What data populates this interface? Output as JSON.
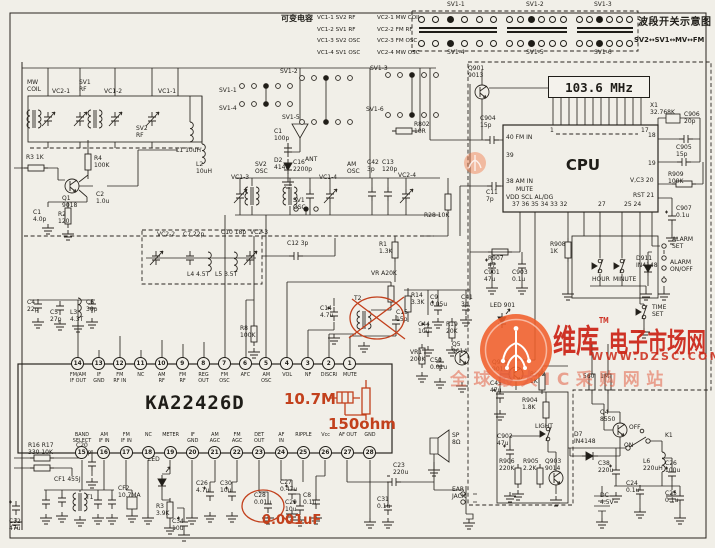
{
  "page": {
    "bg": "#f1efe8",
    "ink": "#1f1d18",
    "red": "#c2401c"
  },
  "legend": {
    "title": "可变电容",
    "rows": [
      [
        "VC1-1 SV2 RF",
        "VC2-1 MW COIL"
      ],
      [
        "VC1-2 SV1 RF",
        "VC2-2 FM RF"
      ],
      [
        "VC1-3 SV2 OSC",
        "VC2-3 FM OSC"
      ],
      [
        "VC1-4 SV1 OSC",
        "VC2-4 MW OSC"
      ]
    ]
  },
  "band_switch": {
    "title": "波段开关示意图",
    "formula": "SV2↔SV1↔MV↔FM",
    "blocks": [
      {
        "top": "SV1-1",
        "bottom": "SV1-4"
      },
      {
        "top": "SV1-2",
        "bottom": "SV1-5"
      },
      {
        "top": "SV1-3",
        "bottom": "SV1-6"
      }
    ]
  },
  "main_ic": {
    "part": "KA22426D",
    "top_pins": [
      {
        "n": "14",
        "label": "FM/AM\nIF OUT"
      },
      {
        "n": "13",
        "label": "IF\nGND"
      },
      {
        "n": "12",
        "label": "FM\nRF IN"
      },
      {
        "n": "11",
        "label": "NC"
      },
      {
        "n": "10",
        "label": "AM\nRF"
      },
      {
        "n": "9",
        "label": "FM\nRF"
      },
      {
        "n": "8",
        "label": "REG\nOUT"
      },
      {
        "n": "7",
        "label": "FM\nOSC"
      },
      {
        "n": "6",
        "label": "AFC"
      },
      {
        "n": "5",
        "label": "AM\nOSC"
      },
      {
        "n": "4",
        "label": "VOL"
      },
      {
        "n": "3",
        "label": "NF"
      },
      {
        "n": "2",
        "label": "DISCRI"
      },
      {
        "n": "1",
        "label": "MUTE"
      }
    ],
    "bottom_pins": [
      {
        "n": "15",
        "label": "BAND\nSELECT"
      },
      {
        "n": "16",
        "label": "AM\nIF IN"
      },
      {
        "n": "17",
        "label": "FM\nIF IN"
      },
      {
        "n": "18",
        "label": "NC"
      },
      {
        "n": "19",
        "label": "METER"
      },
      {
        "n": "20",
        "label": "IF\nGND"
      },
      {
        "n": "21",
        "label": "AM\nAGC"
      },
      {
        "n": "22",
        "label": "FM\nAGC"
      },
      {
        "n": "23",
        "label": "DET\nOUT"
      },
      {
        "n": "24",
        "label": "AF\nIN"
      },
      {
        "n": "25",
        "label": "RIPPLE"
      },
      {
        "n": "26",
        "label": "Vcc"
      },
      {
        "n": "27",
        "label": "AF OUT"
      },
      {
        "n": "28",
        "label": "GND"
      }
    ]
  },
  "cpu": {
    "label": "CPU",
    "display": "103.6 MHz"
  },
  "red_notes": {
    "filter": "10.7M",
    "resistor": "150ohm",
    "capacitor": "0.001uF"
  },
  "watermark": {
    "brand_big": "维库",
    "brand_rest": "电子市场网",
    "tm": "TM",
    "url": "WWW.DZSC.COM",
    "slogan": "全球最大IC采购网站"
  },
  "labels": [
    {
      "t": "MW\nCOIL",
      "x": 27,
      "y": 80
    },
    {
      "t": "VC2-1",
      "x": 52,
      "y": 89
    },
    {
      "t": "SV1\nRF",
      "x": 79,
      "y": 80
    },
    {
      "t": "VC1-2",
      "x": 104,
      "y": 89
    },
    {
      "t": "VC1-1",
      "x": 158,
      "y": 89
    },
    {
      "t": "SV2\nRF",
      "x": 136,
      "y": 126
    },
    {
      "t": "L1 10uH",
      "x": 176,
      "y": 148
    },
    {
      "t": "L2\n10uH",
      "x": 196,
      "y": 162
    },
    {
      "t": "R3 1K",
      "x": 26,
      "y": 155
    },
    {
      "t": "R4\n100K",
      "x": 94,
      "y": 156
    },
    {
      "t": "Q1\n9018",
      "x": 62,
      "y": 196
    },
    {
      "t": "C2\n1.0u",
      "x": 96,
      "y": 192
    },
    {
      "t": "C1\n4.0p",
      "x": 33,
      "y": 210
    },
    {
      "t": "R2\n120",
      "x": 58,
      "y": 212
    },
    {
      "t": "C4\n22p",
      "x": 27,
      "y": 300
    },
    {
      "t": "C5\n27p",
      "x": 50,
      "y": 310
    },
    {
      "t": "L3\n4.3T",
      "x": 70,
      "y": 310
    },
    {
      "t": "C6\n30p",
      "x": 86,
      "y": 300
    },
    {
      "t": "SV1-1",
      "x": 219,
      "y": 88
    },
    {
      "t": "SV1-4",
      "x": 219,
      "y": 106
    },
    {
      "t": "SV1-2",
      "x": 280,
      "y": 69
    },
    {
      "t": "SV1-5",
      "x": 282,
      "y": 115
    },
    {
      "t": "SV1-3",
      "x": 370,
      "y": 66
    },
    {
      "t": "SV1-6",
      "x": 366,
      "y": 107
    },
    {
      "t": "C1\n100p",
      "x": 274,
      "y": 129
    },
    {
      "t": "D2\n4148",
      "x": 274,
      "y": 158
    },
    {
      "t": "ANT",
      "x": 305,
      "y": 157,
      "n": "antenna-label"
    },
    {
      "t": "R802\n10R",
      "x": 414,
      "y": 122
    },
    {
      "t": "VC1-3",
      "x": 231,
      "y": 175
    },
    {
      "t": "SV2\nOSC",
      "x": 255,
      "y": 162
    },
    {
      "t": "C16\n2200p",
      "x": 293,
      "y": 160
    },
    {
      "t": "SV1\nOSC",
      "x": 293,
      "y": 198
    },
    {
      "t": "VC1-4",
      "x": 319,
      "y": 175
    },
    {
      "t": "AM\nOSC",
      "x": 347,
      "y": 162
    },
    {
      "t": "C42\n3p",
      "x": 367,
      "y": 160
    },
    {
      "t": "C13\n120p",
      "x": 382,
      "y": 160
    },
    {
      "t": "VC2-4",
      "x": 398,
      "y": 173
    },
    {
      "t": "C10 18p",
      "x": 221,
      "y": 230
    },
    {
      "t": "VC2-3",
      "x": 250,
      "y": 230
    },
    {
      "t": "C12 3p",
      "x": 287,
      "y": 241
    },
    {
      "t": "VC2-2",
      "x": 157,
      "y": 232
    },
    {
      "t": "C7 22p",
      "x": 183,
      "y": 232
    },
    {
      "t": "L4 4.5T",
      "x": 187,
      "y": 272
    },
    {
      "t": "L5 3.5T",
      "x": 215,
      "y": 272
    },
    {
      "t": "R1\n1.3K",
      "x": 379,
      "y": 242
    },
    {
      "t": "R28 10K",
      "x": 424,
      "y": 213
    },
    {
      "t": "R8\n100K",
      "x": 240,
      "y": 326
    },
    {
      "t": "VR A20K",
      "x": 371,
      "y": 271
    },
    {
      "t": "T2",
      "x": 354,
      "y": 296
    },
    {
      "t": "R14\n3.3K",
      "x": 411,
      "y": 293
    },
    {
      "t": "C15\n15p",
      "x": 396,
      "y": 310
    },
    {
      "t": "C14\n4.7u",
      "x": 320,
      "y": 306
    },
    {
      "t": "C9\n0.05u",
      "x": 430,
      "y": 295
    },
    {
      "t": "C41\n3p",
      "x": 461,
      "y": 295
    },
    {
      "t": "C44\n10u",
      "x": 418,
      "y": 322
    },
    {
      "t": "R19\n20K",
      "x": 446,
      "y": 322
    },
    {
      "t": "VR1\n200K",
      "x": 410,
      "y": 350
    },
    {
      "t": "C50\n0.01u",
      "x": 430,
      "y": 358
    },
    {
      "t": "Q5\n9014",
      "x": 452,
      "y": 342
    },
    {
      "t": "R16 R17\n330 10K",
      "x": 28,
      "y": 443
    },
    {
      "t": "C20\n100p",
      "x": 76,
      "y": 443
    },
    {
      "t": "CF1 455J",
      "x": 54,
      "y": 477
    },
    {
      "t": "T1",
      "x": 86,
      "y": 495
    },
    {
      "t": "C32\n47u",
      "x": 9,
      "y": 519
    },
    {
      "t": "CF2\n10.7MA",
      "x": 118,
      "y": 486
    },
    {
      "t": "LED",
      "x": 148,
      "y": 457
    },
    {
      "t": "R3\n3.9K",
      "x": 156,
      "y": 504
    },
    {
      "t": "C34\n10u",
      "x": 172,
      "y": 519
    },
    {
      "t": "C26\n4.7u",
      "x": 196,
      "y": 481
    },
    {
      "t": "C30\n10u",
      "x": 220,
      "y": 481
    },
    {
      "t": "C28\n0.01u",
      "x": 254,
      "y": 493
    },
    {
      "t": "C27\n0.47u",
      "x": 280,
      "y": 480
    },
    {
      "t": "C29\n10u",
      "x": 285,
      "y": 500
    },
    {
      "t": "C8\n0.1u",
      "x": 303,
      "y": 493
    },
    {
      "t": "C31\n0.1u",
      "x": 377,
      "y": 497
    },
    {
      "t": "C23\n220u",
      "x": 393,
      "y": 463
    },
    {
      "t": "SP\n8Ω",
      "x": 452,
      "y": 433,
      "n": "speaker-label"
    },
    {
      "t": "EAR\nJACK",
      "x": 452,
      "y": 487,
      "n": "ear-jack-label"
    },
    {
      "t": "Q901\n9013",
      "x": 468,
      "y": 66
    },
    {
      "t": "C904\n15p",
      "x": 480,
      "y": 116
    },
    {
      "t": "C11\n7p",
      "x": 486,
      "y": 190
    },
    {
      "t": "X1\n32.768K",
      "x": 650,
      "y": 103
    },
    {
      "t": "C906\n20p",
      "x": 684,
      "y": 112
    },
    {
      "t": "C905\n15p",
      "x": 676,
      "y": 145
    },
    {
      "t": "R909\n100K",
      "x": 668,
      "y": 172
    },
    {
      "t": "C907\n0.1u",
      "x": 676,
      "y": 206
    },
    {
      "t": "R908\n1K",
      "x": 550,
      "y": 242
    },
    {
      "t": "R907\n47",
      "x": 488,
      "y": 256
    },
    {
      "t": "C901\n47u",
      "x": 484,
      "y": 270
    },
    {
      "t": "C903\n0.1u",
      "x": 512,
      "y": 270
    },
    {
      "t": "HOUR",
      "x": 592,
      "y": 277,
      "n": "hour-switch-label"
    },
    {
      "t": "MINUTE",
      "x": 613,
      "y": 277,
      "n": "minute-switch-label"
    },
    {
      "t": "D911\nIN4148",
      "x": 636,
      "y": 256
    },
    {
      "t": "ALARM\nSET",
      "x": 672,
      "y": 237,
      "n": "alarm-set-label"
    },
    {
      "t": "ALARM\nON/OFF",
      "x": 670,
      "y": 260,
      "n": "alarm-onoff-label"
    },
    {
      "t": "TIME\nSET",
      "x": 652,
      "y": 305,
      "n": "time-set-label"
    },
    {
      "t": "LED 901",
      "x": 490,
      "y": 303
    },
    {
      "t": "Q902\n9013",
      "x": 492,
      "y": 360
    },
    {
      "t": "C45\n47u",
      "x": 490,
      "y": 381
    },
    {
      "t": "R902\n1K",
      "x": 530,
      "y": 372
    },
    {
      "t": "560",
      "x": 583,
      "y": 374
    },
    {
      "t": "1M",
      "x": 600,
      "y": 374
    },
    {
      "t": "R904\n1.8K",
      "x": 522,
      "y": 398
    },
    {
      "t": "LIGHT",
      "x": 535,
      "y": 424,
      "n": "light-switch-label"
    },
    {
      "t": "C902\n47u",
      "x": 497,
      "y": 434
    },
    {
      "t": "R906\n220K",
      "x": 499,
      "y": 459
    },
    {
      "t": "R905\n2.2K",
      "x": 523,
      "y": 459
    },
    {
      "t": "Q903\n9014",
      "x": 545,
      "y": 459
    },
    {
      "t": "D7\nIN4148",
      "x": 574,
      "y": 432
    },
    {
      "t": "Q4\n8550",
      "x": 600,
      "y": 410
    },
    {
      "t": "OFF",
      "x": 629,
      "y": 425
    },
    {
      "t": "ON",
      "x": 624,
      "y": 443
    },
    {
      "t": "K1",
      "x": 665,
      "y": 433,
      "n": "power-switch-label"
    },
    {
      "t": "L6\n220uH",
      "x": 643,
      "y": 459
    },
    {
      "t": "C38\n220u",
      "x": 598,
      "y": 461
    },
    {
      "t": "C26\n100u",
      "x": 665,
      "y": 461
    },
    {
      "t": "C24\n0.1u",
      "x": 626,
      "y": 481
    },
    {
      "t": "C25\n0.1u",
      "x": 665,
      "y": 491
    },
    {
      "t": "DC\n4.5V",
      "x": 600,
      "y": 493,
      "n": "battery-label"
    },
    {
      "t": "40 FM IN",
      "x": 506,
      "y": 135
    },
    {
      "t": "39",
      "x": 506,
      "y": 153
    },
    {
      "t": "38 AM IN",
      "x": 506,
      "y": 179
    },
    {
      "t": "MUTE",
      "x": 516,
      "y": 187
    },
    {
      "t": "VDD SCL AL/DG",
      "x": 506,
      "y": 195
    },
    {
      "t": "1",
      "x": 550,
      "y": 128
    },
    {
      "t": "17",
      "x": 641,
      "y": 128
    },
    {
      "t": "18",
      "x": 648,
      "y": 133
    },
    {
      "t": "19",
      "x": 648,
      "y": 161
    },
    {
      "t": "V,C3 20",
      "x": 630,
      "y": 178
    },
    {
      "t": "RST 21",
      "x": 633,
      "y": 193
    },
    {
      "t": "37 36 35 34 33 32",
      "x": 512,
      "y": 202
    },
    {
      "t": "27",
      "x": 598,
      "y": 202
    },
    {
      "t": "25 24",
      "x": 624,
      "y": 202
    }
  ]
}
